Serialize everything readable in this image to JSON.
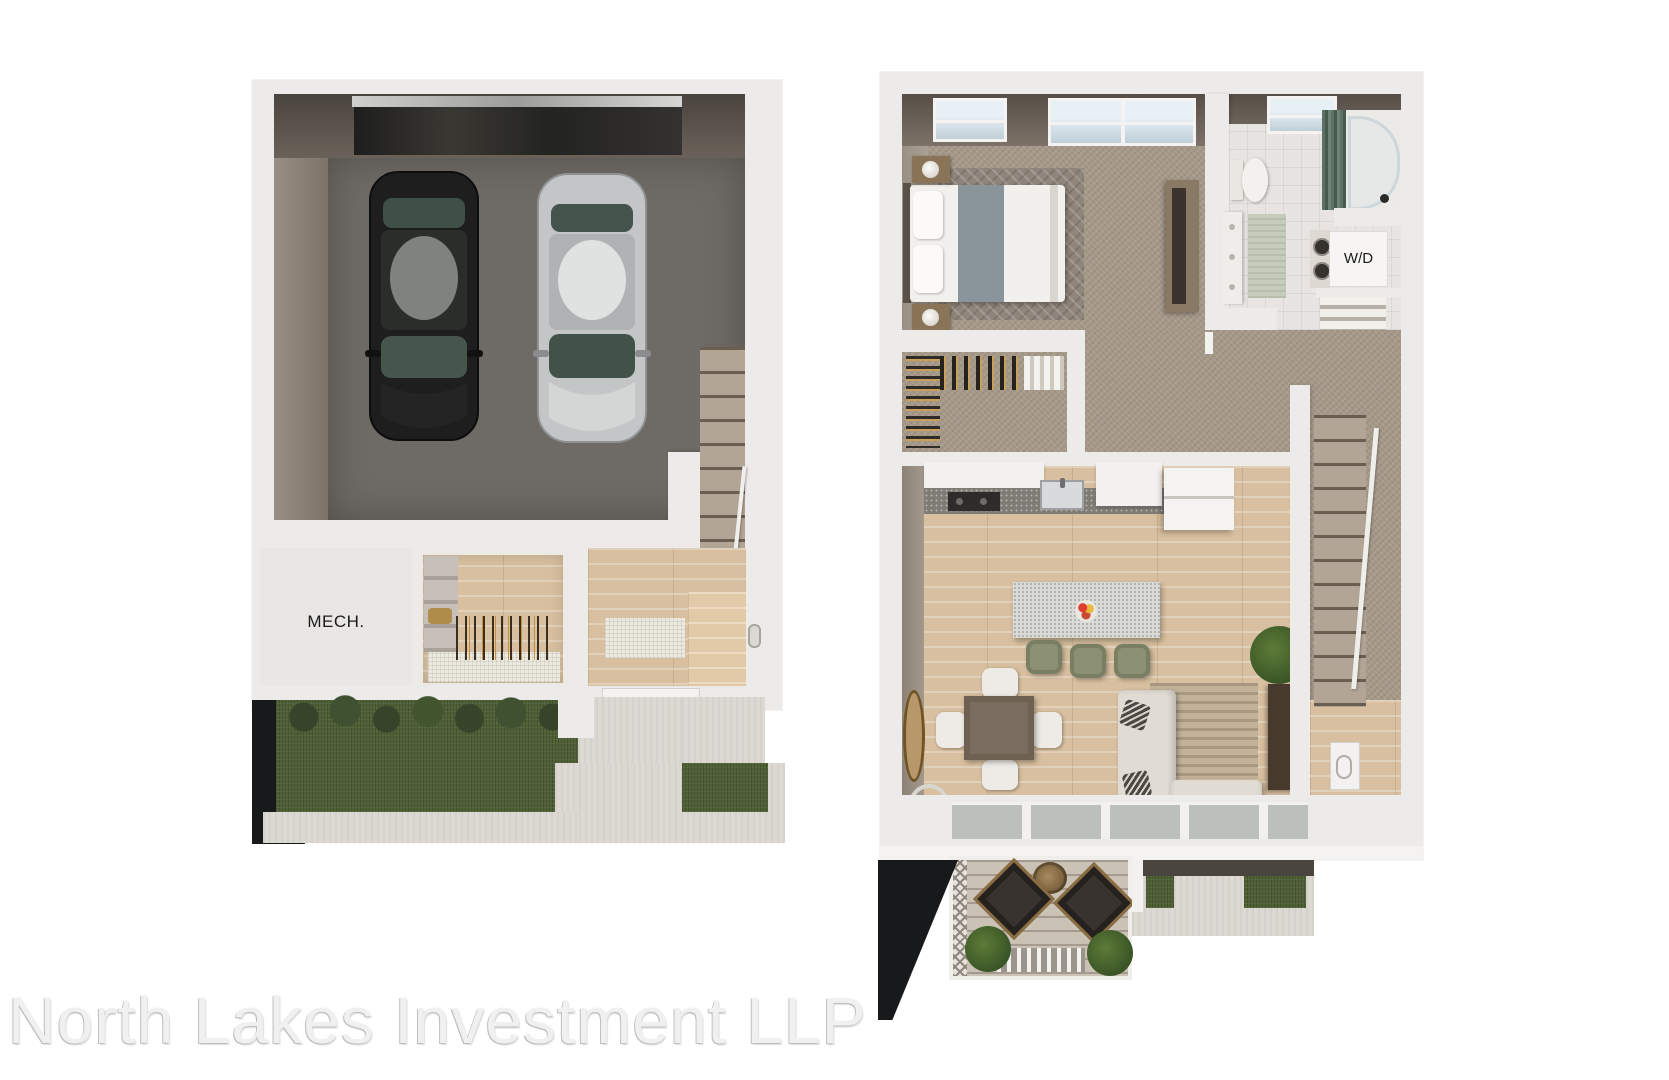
{
  "watermark": {
    "text": "North Lakes Investment LLP"
  },
  "plans": {
    "garage_level": {
      "labels": {
        "mech": "MECH."
      }
    },
    "main_level": {
      "labels": {
        "wd": "W/D"
      }
    }
  },
  "colors": {
    "background": "#ffffff",
    "wall": "#edebe9",
    "wall_shadow": "#d8d3cd",
    "wall_face_dark": "#5e564e",
    "wall_face_light": "#a3988c",
    "garage_floor": "#6e6a65",
    "garage_door": "#26251f",
    "wood_floor": "#d7bf9f",
    "carpet": "#a59888",
    "stair_carpet": "#b3a595",
    "tile": "#e7e4e1",
    "grass": "#4f6036",
    "shrub": "#36452a",
    "concrete": "#dcd8d2",
    "shadow": "#17191b",
    "deck_wood": "#cbc2b6",
    "car_dark": "#1d1e1d",
    "car_silver": "#c3c5c6",
    "car_glass": "#46564d",
    "island_top": "#dadad6",
    "stool": "#8b9172",
    "sofa": "#e0dcd4",
    "rug": "#c2b29a",
    "table_wood": "#6f6152",
    "plant": "#4c682f",
    "glass_door": "#bcbfba",
    "watermark": "#f0f0f0"
  }
}
